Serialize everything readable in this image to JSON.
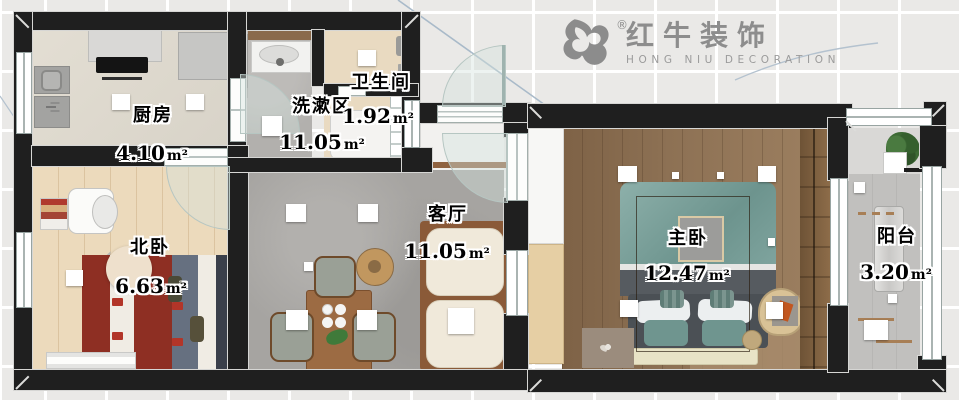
{
  "logo": {
    "brand": "红牛装饰",
    "subtitle": "HONG NIU DECORATION",
    "registered": "®",
    "icon": "hongniu-bull-icon"
  },
  "rooms": [
    {
      "id": "kitchen",
      "name": "厨房",
      "area": "4.10",
      "unit": "m²"
    },
    {
      "id": "washing-area",
      "name": "洗漱区",
      "area": "11.05",
      "unit": "m²"
    },
    {
      "id": "bathroom",
      "name": "卫生间",
      "area": "1.92",
      "unit": "m²"
    },
    {
      "id": "north-bedroom",
      "name": "北卧",
      "area": "6.63",
      "unit": "m²"
    },
    {
      "id": "living-room",
      "name": "客厅",
      "area": "11.05",
      "unit": "m²"
    },
    {
      "id": "master-bedroom",
      "name": "主卧",
      "area": "12.47",
      "unit": "m²"
    },
    {
      "id": "balcony",
      "name": "阳台",
      "area": "3.20",
      "unit": "m²"
    }
  ],
  "colors": {
    "wall": "#1f1f1f",
    "background": "#eae9e7",
    "grid_line": "#ffffff",
    "logo_gray": "#8d8d8d",
    "blueprint_accent": "#a9bac9"
  }
}
